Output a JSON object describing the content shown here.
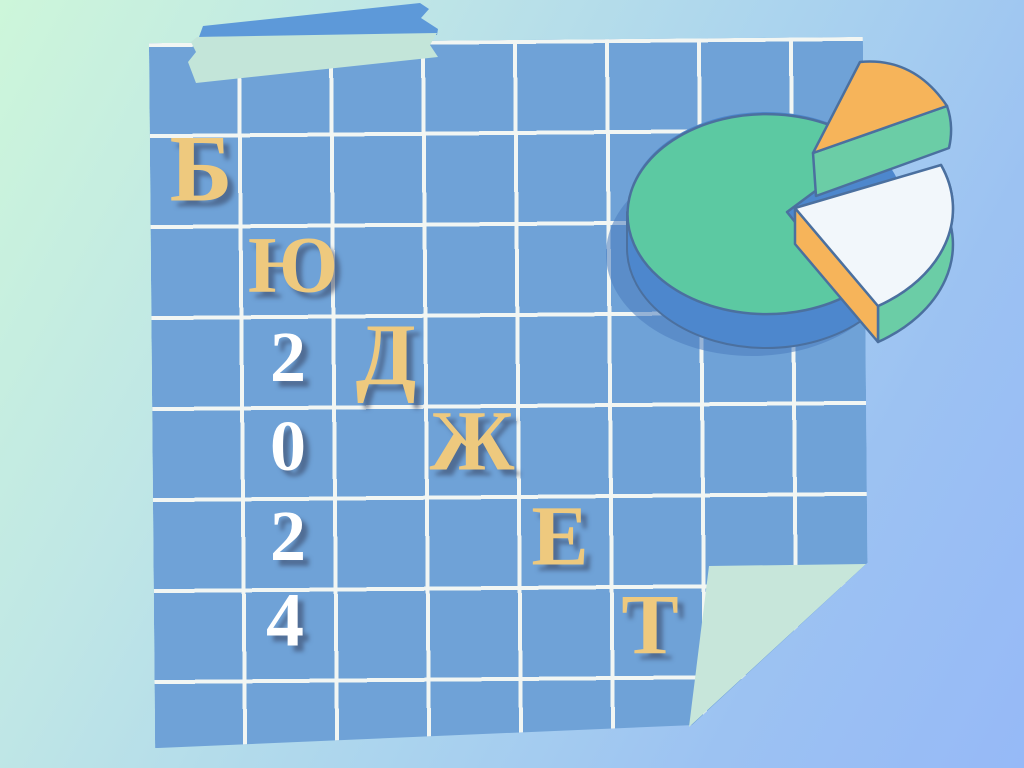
{
  "background": {
    "gradient_top_left": "#cdf6da",
    "gradient_middle": "#abd4ee",
    "gradient_bottom_right": "#96b9f7"
  },
  "sticky_note": {
    "paper_color": "#6fa2d7",
    "grid_line_color": "#f2f6f3",
    "fold_color": "#c7e6da"
  },
  "tape": {
    "blue_color": "#5d99d9",
    "green_color": "#c3e5d9"
  },
  "title": {
    "word": "БЮДЖЕТ",
    "year": "2024",
    "letter_color": "#eec97e",
    "digit_color": "#ffffff",
    "letters": [
      {
        "char": "Б"
      },
      {
        "char": "Ю"
      },
      {
        "char": "Д"
      },
      {
        "char": "Ж"
      },
      {
        "char": "Е"
      },
      {
        "char": "Т"
      }
    ],
    "digits": [
      {
        "char": "2"
      },
      {
        "char": "0"
      },
      {
        "char": "2"
      },
      {
        "char": "4"
      }
    ]
  },
  "pie_illustration": {
    "top_color": "#5cc9a2",
    "base_color": "#4d87cd",
    "shadow_color": "#4a7cbe",
    "side_green_color": "#6bcda6",
    "wedge_orange_color": "#f6b45a",
    "wedge_white_color": "#f2f7fb",
    "outline_color": "#4b709f"
  }
}
